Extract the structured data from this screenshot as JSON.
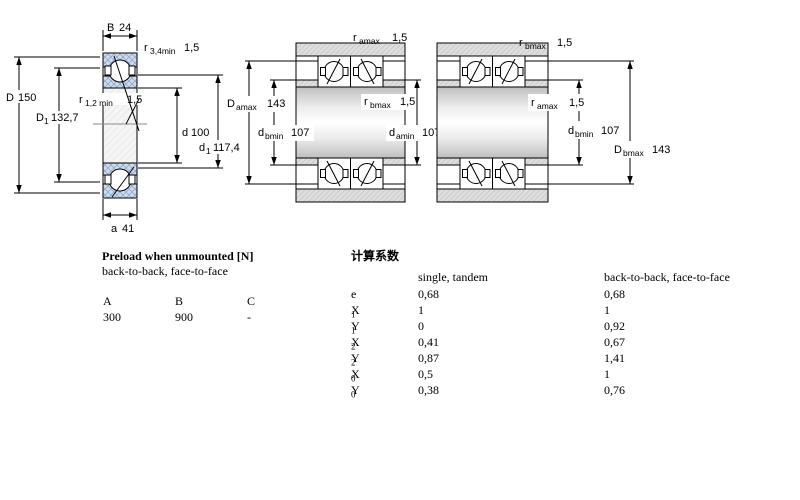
{
  "colors": {
    "ring_hatch": "#cfdcec",
    "ring_hatch_line": "#93a9cc",
    "housing_grey": "#dedede",
    "line": "#000000"
  },
  "single": {
    "B": {
      "base": "B",
      "value": "24"
    },
    "r34": {
      "base": "r",
      "sub": "3,4min",
      "value": "1,5"
    },
    "D": {
      "base": "D",
      "value": "150"
    },
    "D1": {
      "base": "D",
      "sub": "1",
      "value": "132,7"
    },
    "r12": {
      "base": "r",
      "sub": "1,2 min",
      "value": "1,5"
    },
    "d": {
      "base": "d",
      "value": "100"
    },
    "d1": {
      "base": "d",
      "sub": "1",
      "value": "117,4"
    },
    "a": {
      "base": "a",
      "value": "41"
    }
  },
  "pair1": {
    "r_amax": {
      "base": "r",
      "sub": "amax",
      "value": "1,5"
    },
    "D_amax": {
      "base": "D",
      "sub": "amax",
      "value": "143"
    },
    "d_bmin": {
      "base": "d",
      "sub": "bmin",
      "value": "107"
    },
    "r_bmax": {
      "base": "r",
      "sub": "bmax",
      "value": "1,5"
    },
    "d_amin": {
      "base": "d",
      "sub": "amin",
      "value": "107"
    }
  },
  "pair2": {
    "r_bmax": {
      "base": "r",
      "sub": "bmax",
      "value": "1,5"
    },
    "r_amax": {
      "base": "r",
      "sub": "amax",
      "value": "1,5"
    },
    "d_bmin": {
      "base": "d",
      "sub": "bmin",
      "value": "107"
    },
    "D_bmax": {
      "base": "D",
      "sub": "bmax",
      "value": "143"
    }
  },
  "preload_table": {
    "title": "Preload when unmounted [N]",
    "subtitle": "back-to-back, face-to-face",
    "columns": [
      "A",
      "B",
      "C"
    ],
    "values": [
      "300",
      "900",
      "-"
    ]
  },
  "factors_table": {
    "title": "计算系数",
    "col1_header": "single, tandem",
    "col2_header": "back-to-back, face-to-face",
    "rows": [
      {
        "base": "e",
        "sub": "",
        "v1": "0,68",
        "v2": "0,68"
      },
      {
        "base": "X",
        "sub": "1",
        "v1": "1",
        "v2": "1"
      },
      {
        "base": "Y",
        "sub": "1",
        "v1": "0",
        "v2": "0,92"
      },
      {
        "base": "X",
        "sub": "2",
        "v1": "0,41",
        "v2": "0,67"
      },
      {
        "base": "Y",
        "sub": "2",
        "v1": "0,87",
        "v2": "1,41"
      },
      {
        "base": "X",
        "sub": "0",
        "v1": "0,5",
        "v2": "1"
      },
      {
        "base": "Y",
        "sub": "0",
        "v1": "0,38",
        "v2": "0,76"
      }
    ]
  }
}
